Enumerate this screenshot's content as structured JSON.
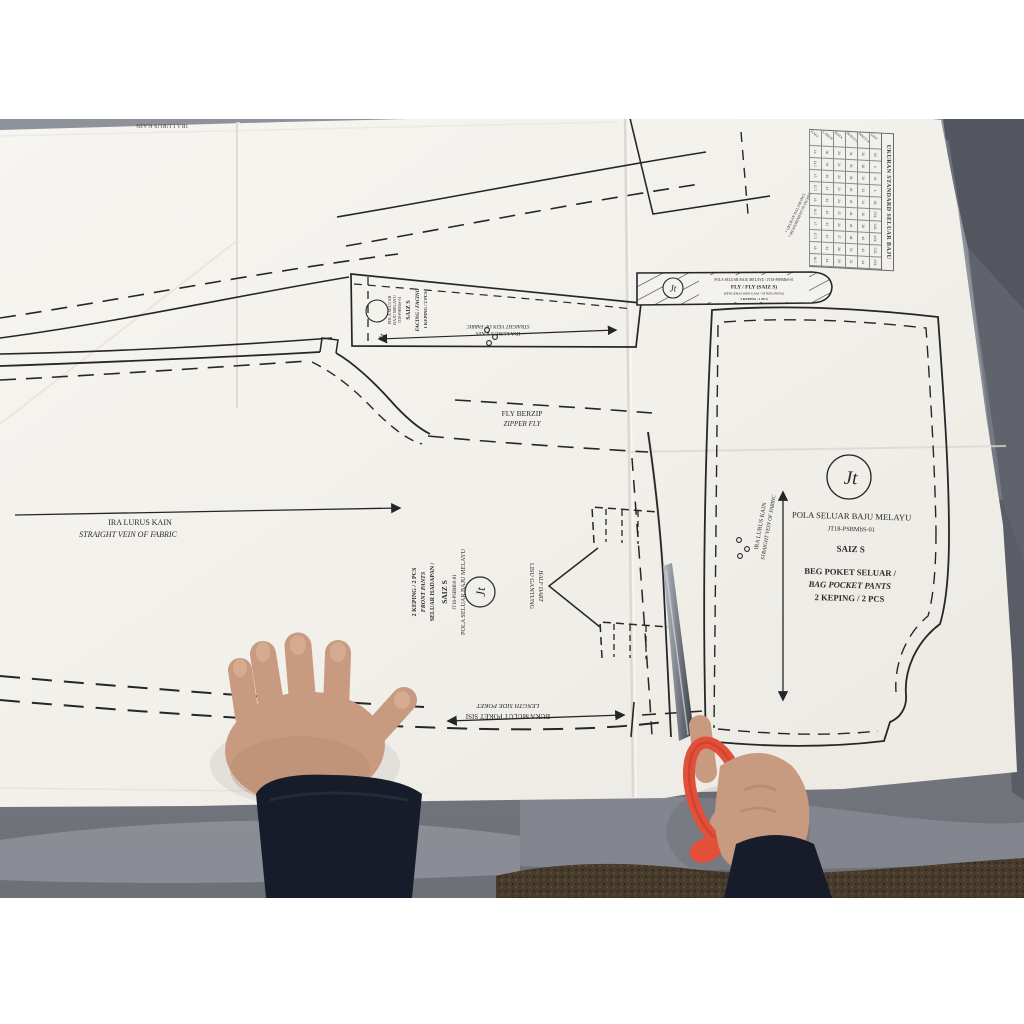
{
  "photo": {
    "description": "Folded paper sewing pattern (pola seluar baju melayu) on a grey table; a child's left hand holds the paper flat while the right hand cuts along a pattern edge with orange-handled scissors.",
    "colors": {
      "paper": "#f4f2ee",
      "fabric_grey": "#7b7e87",
      "carpet_brown": "#473b2b",
      "sleeve_navy": "#171c2b",
      "skin": "#c89a80",
      "scissor_handle": "#e2503a",
      "pattern_line": "#26262a"
    }
  },
  "brand": {
    "monogram": "Jt"
  },
  "labels": {
    "top_edge_grain": "IRA LURUS KAIN",
    "grain_my": "IRA LURUS KAIN",
    "grain_en": "STRAIGHT VEIN OF FABRIC",
    "zipper_my": "FLY BERZIP",
    "zipper_en": "ZIPPER FLY",
    "dart_my": "LISU GANTUNG",
    "dart_en": "HALF DART",
    "pocket_my": "BUKA MULUT POKET SISI",
    "pocket_en": "LENGTH SIDE POKET"
  },
  "pieces": {
    "front_pants": {
      "brand": "POLA SELUAR BAJU MELAYU",
      "code": "JT18-PSBMbS-01",
      "size": "SAIZ S",
      "name_my": "SELUAR HADAPAN /",
      "name_en": "FRONT PANTS",
      "qty": "2 KEPING / 2 PCS"
    },
    "bag_pocket": {
      "brand": "POLA SELUAR BAJU MELAYU",
      "code": "JT18-PSBMbS-01",
      "size": "SAIZ S",
      "name_my": "BEG POKET SELUAR /",
      "name_en": "BAG POCKET PANTS",
      "qty": "2 KEPING / 2 PCS"
    },
    "facing": {
      "brand_1": "POLA SELUAR",
      "brand_2": "BAJU MELAYU",
      "code": "JT18-PSBMbS-01",
      "size": "SAIZ S",
      "name": "FACING / FACING",
      "qty": "1 KEPING / 2 PCS"
    },
    "fly": {
      "header": "POLA SELUAR BAJU MELAYU / JT18-PSBMbS-01",
      "name": "FLY / FLY (SAIZ S)",
      "note": "(PENGERAS BER-GAM / INTERLINING)",
      "qty": "1 KEPING / 1 PCS"
    }
  },
  "size_chart": {
    "title": "UKURAN STANDARD SELUAR BAJU MELAYU",
    "note_1": "* UKURAN DALAM INCI",
    "note_2": "* MEASUREMENT IN INCHES",
    "row_headers": [
      "SAIZ",
      "PINGGANG",
      "PUNGGUNG",
      "PEHA",
      "LABUH",
      "KAKI"
    ],
    "rows": [
      [
        "XS",
        "S",
        "M",
        "L",
        "XL",
        "2XL",
        "3XL",
        "4XL",
        "5XL",
        "6XL"
      ],
      [
        "26",
        "28",
        "30",
        "32",
        "34",
        "36",
        "38",
        "40",
        "42",
        "44"
      ],
      [
        "34",
        "36",
        "38",
        "40",
        "42",
        "44",
        "46",
        "48",
        "50",
        "52"
      ],
      [
        "20",
        "21",
        "22",
        "23",
        "24",
        "25",
        "26",
        "27",
        "28",
        "29"
      ],
      [
        "38",
        "39",
        "40",
        "41",
        "42",
        "42",
        "43",
        "43",
        "44",
        "44"
      ],
      [
        "14",
        "14.5",
        "15",
        "15.5",
        "16",
        "16.5",
        "17",
        "17.5",
        "18",
        "18.5"
      ]
    ]
  }
}
